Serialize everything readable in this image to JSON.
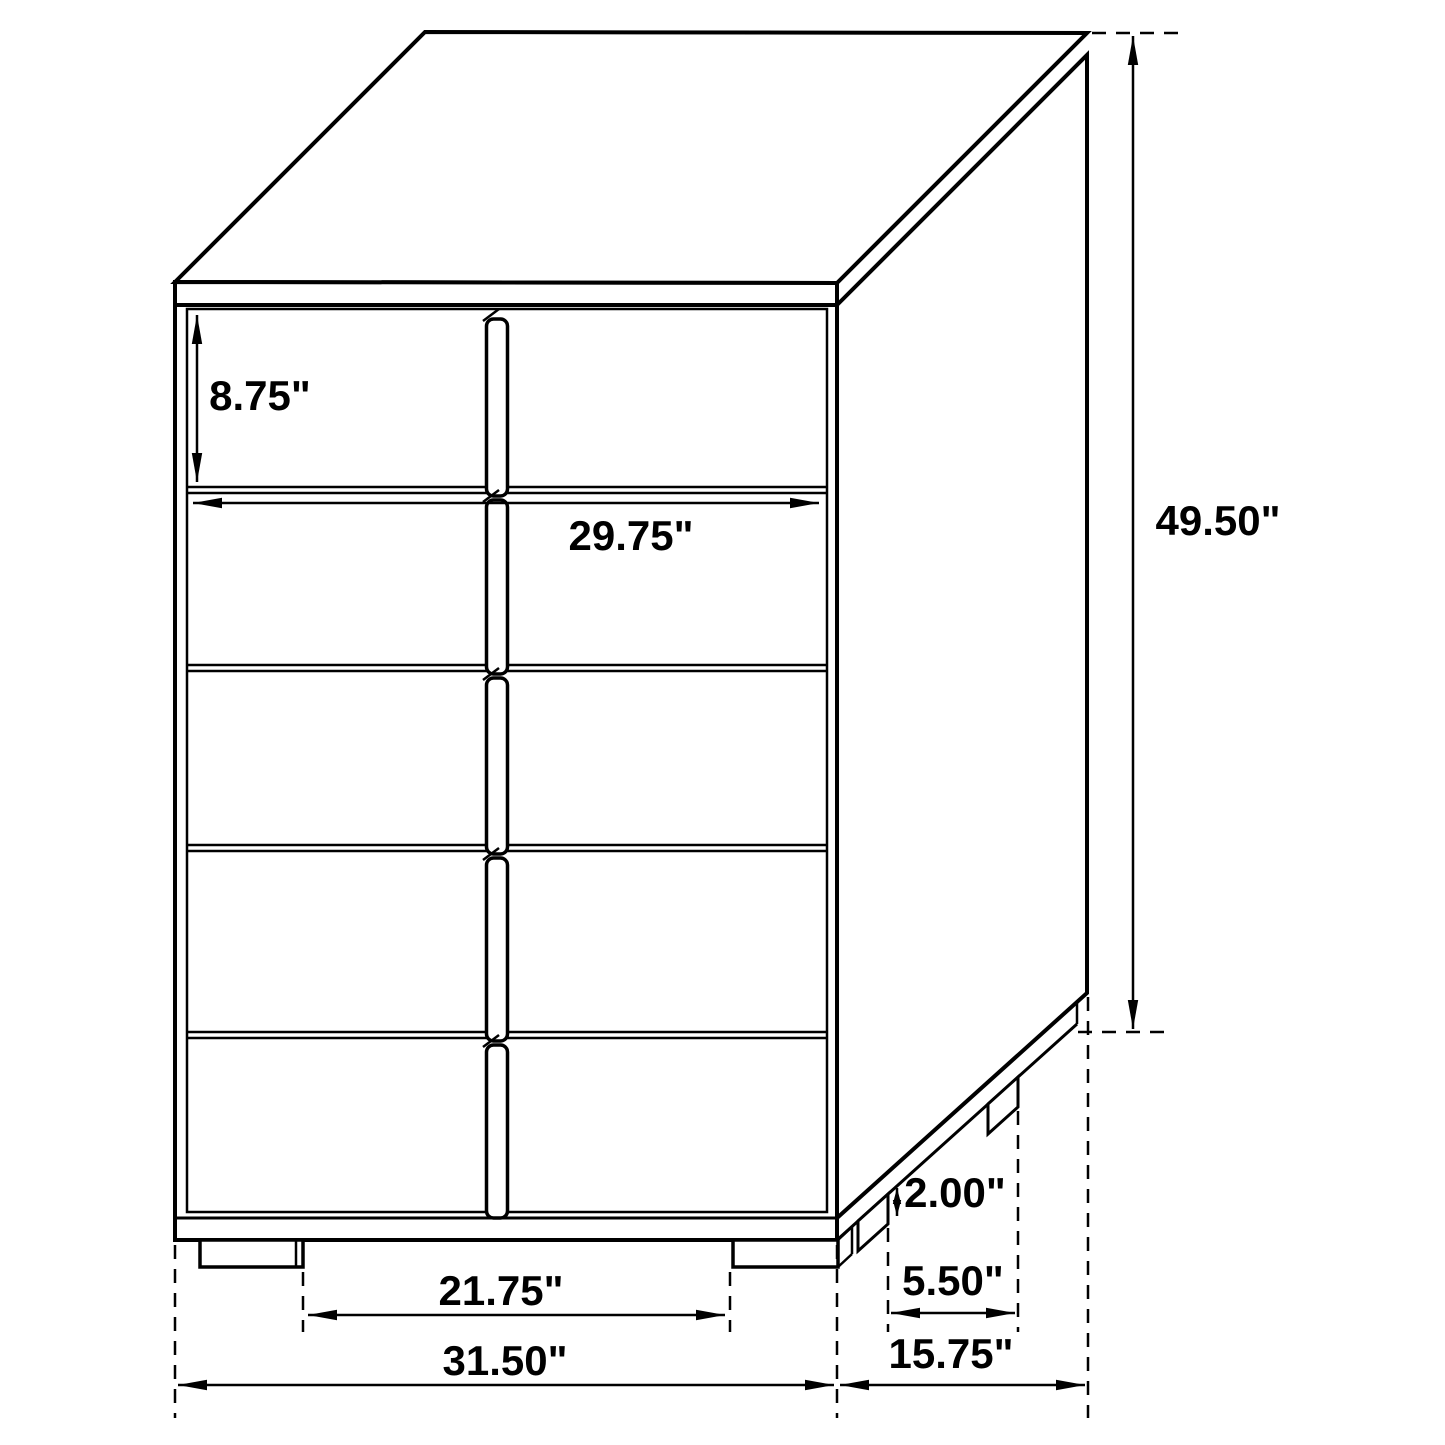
{
  "diagram": {
    "kind": "furniture-dimension-drawing",
    "unit": "inches",
    "drawer_count": 5,
    "labels": {
      "drawer_height": "8.75\"",
      "drawer_width": "29.75\"",
      "overall_height": "49.50\"",
      "leg_height": "2.00\"",
      "side_leg_inset": "5.50\"",
      "front_leg_span": "21.75\"",
      "overall_width": "31.50\"",
      "overall_depth": "15.75\""
    },
    "colors": {
      "line": "#000000",
      "background": "#ffffff"
    }
  }
}
